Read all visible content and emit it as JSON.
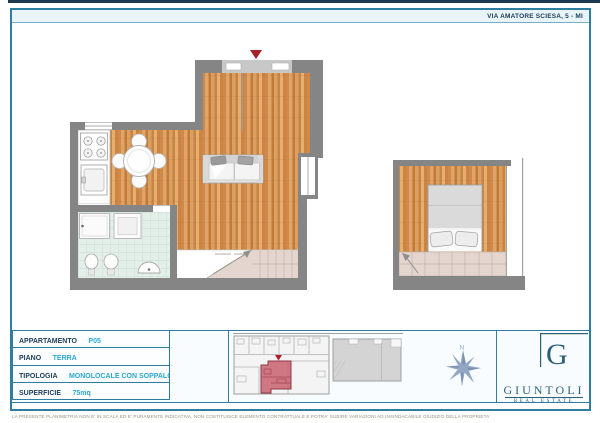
{
  "page": {
    "address": "VIA AMATORE SCIESA, 5 - MI",
    "disclaimer": "LA PRESENTE PLANIMETRIA NON E' IN SCALA ED E' PURAMENTE INDICATIVA, NON COSTITUISCE ELEMENTO CONTRATTUALE E POTRA' SUBIRE VARIAZIONI AD INSINDACABILE GIUDIZIO DELLA PROPRIETA'"
  },
  "details": {
    "rows": [
      {
        "label": "APPARTAMENTO",
        "value": "P05"
      },
      {
        "label": "PIANO",
        "value": "TERRA"
      },
      {
        "label": "TIPOLOGIA",
        "value": "MONOLOCALE CON SOPPALCO"
      },
      {
        "label": "SUPERFICIE",
        "value": "75mq"
      }
    ]
  },
  "compass": {
    "north_label": "N"
  },
  "brand": {
    "monogram": "G",
    "name": "GIUNTOLI",
    "tagline": "REAL ESTATE"
  },
  "colors": {
    "accent_teal": "#2e7ea0",
    "value_cyan": "#29a8d1",
    "navy": "#1b3c5a",
    "logo_teal": "#2a6179",
    "wall_gray": "#858585",
    "wood": "#d59354",
    "bath_tile": "#e4efe9",
    "stair_beige": "#e4d6ce",
    "unit_highlight_red": "#c96070",
    "marker_red": "#a81e2a",
    "compass_blue": "#93a7c5"
  }
}
